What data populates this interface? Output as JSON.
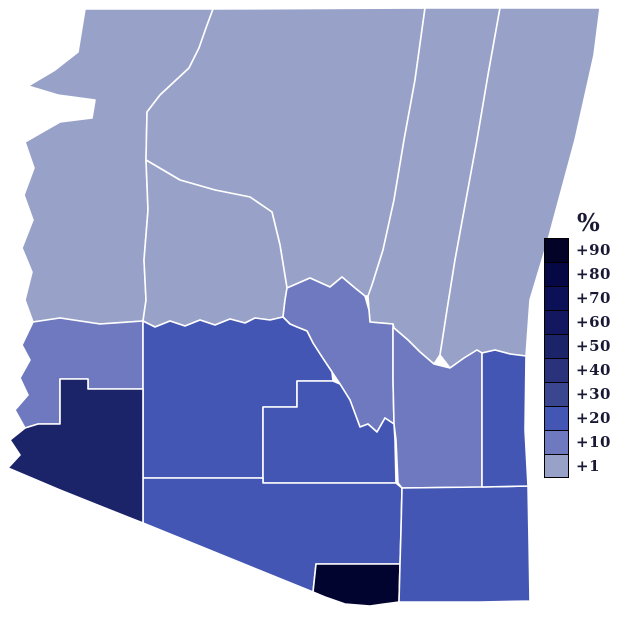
{
  "page": {
    "background_color": "#ffffff",
    "description": "Choropleth map of Arizona counties shaded by percentage value"
  },
  "map": {
    "border_color": "#ffffff",
    "counties": [
      {
        "name": "mohave",
        "value_label": "+1",
        "color": "#98a1c8",
        "points": "85,9 213,9 206,28 199,48 189,68 160,95 147,112 146,160 148,210 144,260 146,300 143,321 100,324 60,318 33,322 25,300 32,272 22,248 33,220 24,195 34,168 25,142 60,122 92,118 95,100 58,95 28,86 55,70 78,52"
      },
      {
        "name": "coconino",
        "value_label": "+1",
        "color": "#98a1c8",
        "points": "213,9 425,8 415,80 404,140 394,200 383,250 372,285 369,296 365,296 355,288 342,277 330,287 310,278 287,288 280,245 272,212 250,197 215,190 180,180 146,160 147,112 160,95 189,68 199,48 206,28"
      },
      {
        "name": "navajo",
        "value_label": "+1",
        "color": "#98a1c8",
        "points": "425,8 500,8 488,75 477,140 466,200 455,260 447,310 443,336 440,355 434,364 420,352 408,340 394,328 393,324 370,322 369,310 368,296 372,285 383,250 394,200 404,140 415,80"
      },
      {
        "name": "apache",
        "value_label": "+1",
        "color": "#98a1c8",
        "points": "500,8 600,8 594,55 575,140 548,240 530,300 526,356 510,354 495,350 482,353 477,350 464,358 450,368 440,355 443,336 447,310 455,260 466,200 477,140 488,75"
      },
      {
        "name": "yavapai",
        "value_label": "+1",
        "color": "#98a1c8",
        "points": "146,160 180,180 215,190 250,197 272,212 280,245 287,288 285,300 283,317 270,320 255,318 245,323 230,319 215,325 200,320 185,326 170,321 155,327 143,321 146,300 144,260 148,210"
      },
      {
        "name": "la-paz",
        "value_label": "+10",
        "color": "#6e79bf",
        "points": "33,322 60,318 100,324 143,321 143,389 88,389 88,379 60,379 60,424 38,424 25,428 15,410 28,395 20,378 30,360 22,345"
      },
      {
        "name": "gila",
        "value_label": "+10",
        "color": "#6e79bf",
        "points": "287,288 310,278 330,287 342,277 355,288 365,296 369,310 370,322 393,324 393,380 394,424 385,418 377,432 368,424 360,427 350,400 340,384 332,372 322,357 313,343 307,331 297,327 290,324 283,317 285,300"
      },
      {
        "name": "graham",
        "value_label": "+10",
        "color": "#6e79bf",
        "points": "394,328 408,340 420,352 434,364 450,368 464,358 477,350 482,353 482,487 402,488 398,483 396,440 394,424 393,380 393,328"
      },
      {
        "name": "maricopa",
        "value_label": "+20",
        "color": "#4456b3",
        "points": "143,321 155,327 170,321 185,326 200,320 215,325 230,319 245,323 255,318 270,320 283,317 290,324 297,327 307,331 313,343 322,357 332,372 333,381 297,381 297,407 263,407 263,478 143,478 143,389"
      },
      {
        "name": "pinal",
        "value_label": "+20",
        "color": "#4456b3",
        "points": "297,381 333,381 340,384 350,400 360,427 368,424 377,432 385,418 394,424 395,440 396,483 263,483 263,478 263,407 297,407"
      },
      {
        "name": "pima",
        "value_label": "+20",
        "color": "#4456b3",
        "points": "143,478 263,478 263,483 396,483 402,488 401,530 400,564 316,564 313,592 143,523"
      },
      {
        "name": "santa-cruz",
        "value_label": "+90",
        "color": "#020430",
        "points": "316,564 400,564 399,602 370,606 345,604 325,597 313,592"
      },
      {
        "name": "cochise",
        "value_label": "+20",
        "color": "#4456b3",
        "points": "402,488 482,487 528,486 529,540 530,601 480,602 430,602 399,602 400,564 401,530"
      },
      {
        "name": "greenlee",
        "value_label": "+20",
        "color": "#4456b3",
        "points": "482,353 495,350 510,354 526,356 525,430 528,486 482,487"
      },
      {
        "name": "yuma",
        "value_label": "+50",
        "color": "#1b2369",
        "points": "38,424 60,424 60,379 88,379 88,389 143,389 143,523 100,506 60,490 8,468 20,455 10,440 25,428"
      }
    ]
  },
  "legend": {
    "title": "%",
    "text_color": "#191935",
    "swatch_border_color": "#000000",
    "items": [
      {
        "label": "+90",
        "color": "#030327"
      },
      {
        "label": "+80",
        "color": "#060845"
      },
      {
        "label": "+70",
        "color": "#0b1057"
      },
      {
        "label": "+60",
        "color": "#121760"
      },
      {
        "label": "+50",
        "color": "#1b2369"
      },
      {
        "label": "+40",
        "color": "#2a327b"
      },
      {
        "label": "+30",
        "color": "#3a468f"
      },
      {
        "label": "+20",
        "color": "#4456b3"
      },
      {
        "label": "+10",
        "color": "#6e79bf"
      },
      {
        "label": "+1",
        "color": "#98a1c8"
      }
    ]
  }
}
